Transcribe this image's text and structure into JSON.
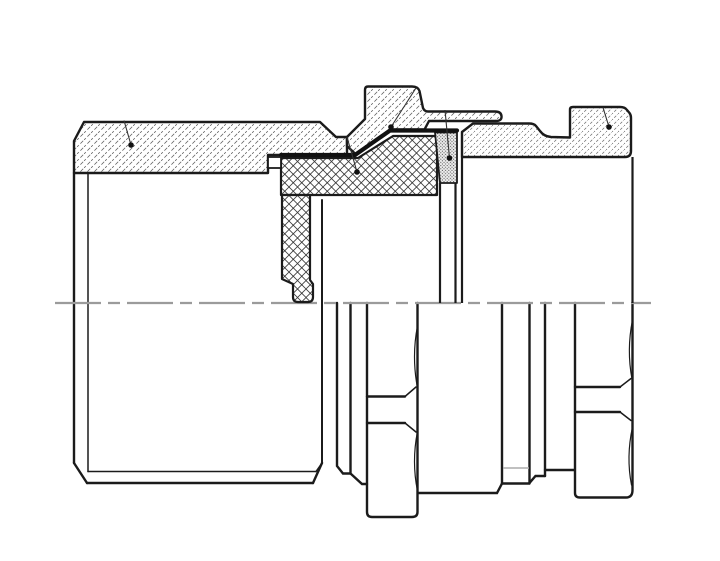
{
  "drawing": {
    "title": "Sectioned assembly drawing of a tube coupling",
    "type": "technical-cross-section",
    "background_color": "#ffffff",
    "outline_color": "#1b1b1b",
    "hatch_color": "#5a5a5a",
    "seal_hatch_color": "#3c3c3c",
    "centerline_color": "#9b9b9b",
    "hidden_line_color": "#ababab",
    "leader_dot_color": "#111111",
    "centerline_y": 303,
    "parts": [
      {
        "name": "outer-shell",
        "hatch": "diagonal-dashed",
        "region": "left"
      },
      {
        "name": "clamp-ring-with-tab",
        "hatch": "diagonal-dashed",
        "region": "center-top"
      },
      {
        "name": "seal-grommet",
        "hatch": "diamond-crosshatch",
        "region": "center"
      },
      {
        "name": "seal-washer",
        "hatch": "stipple-dots",
        "region": "center-right"
      },
      {
        "name": "coupling-nut",
        "hatch": "diagonal-dashed-fine",
        "region": "right"
      }
    ],
    "leader_callouts": 5
  }
}
